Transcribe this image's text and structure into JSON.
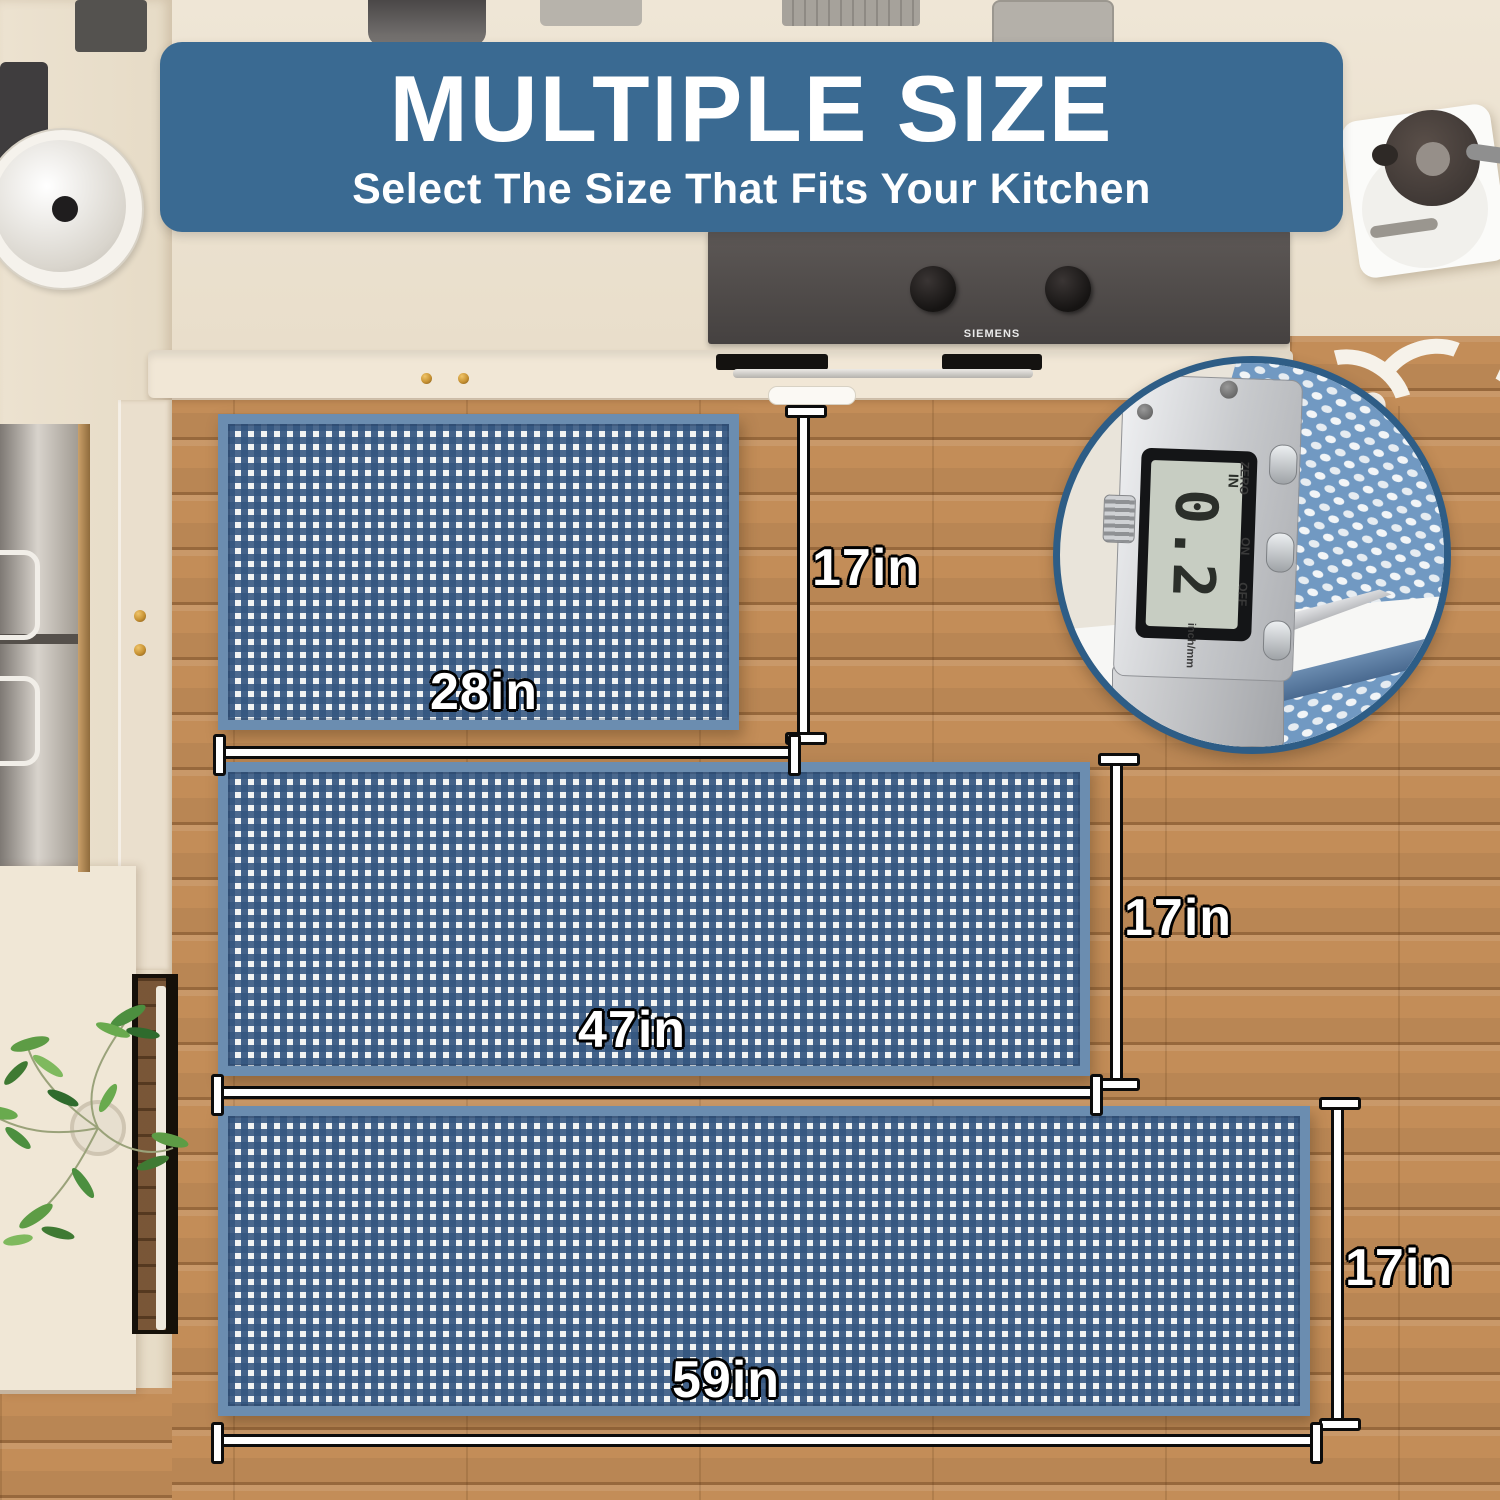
{
  "banner": {
    "title": "MULTIPLE SIZE",
    "subtitle": "Select The Size That Fits Your Kitchen"
  },
  "rugs": [
    {
      "label": "small mat",
      "width_label": "28in",
      "height_label": "17in"
    },
    {
      "label": "medium runner",
      "width_label": "47in",
      "height_label": "17in"
    },
    {
      "label": "large runner",
      "width_label": "59in",
      "height_label": "17in"
    }
  ],
  "thickness_inset": {
    "lcd_value": "0.2",
    "lcd_unit": "IN",
    "button_labels": [
      "ZERO",
      "ON",
      "OFF"
    ],
    "mode_switch_label": "inch/mm"
  },
  "appliances": {
    "cooktop_brand": "SIEMENS"
  },
  "colors": {
    "banner_bg": "#3a6a92",
    "rug_border": "#6b8db0",
    "rug_check_blue": "#38587f",
    "wood_floor": "#c38d58",
    "counter_cream": "#ece2d0",
    "dimension_line": "#ffffff",
    "dimension_outline": "#0c0c0c",
    "inset_ring": "#2e5d86"
  }
}
